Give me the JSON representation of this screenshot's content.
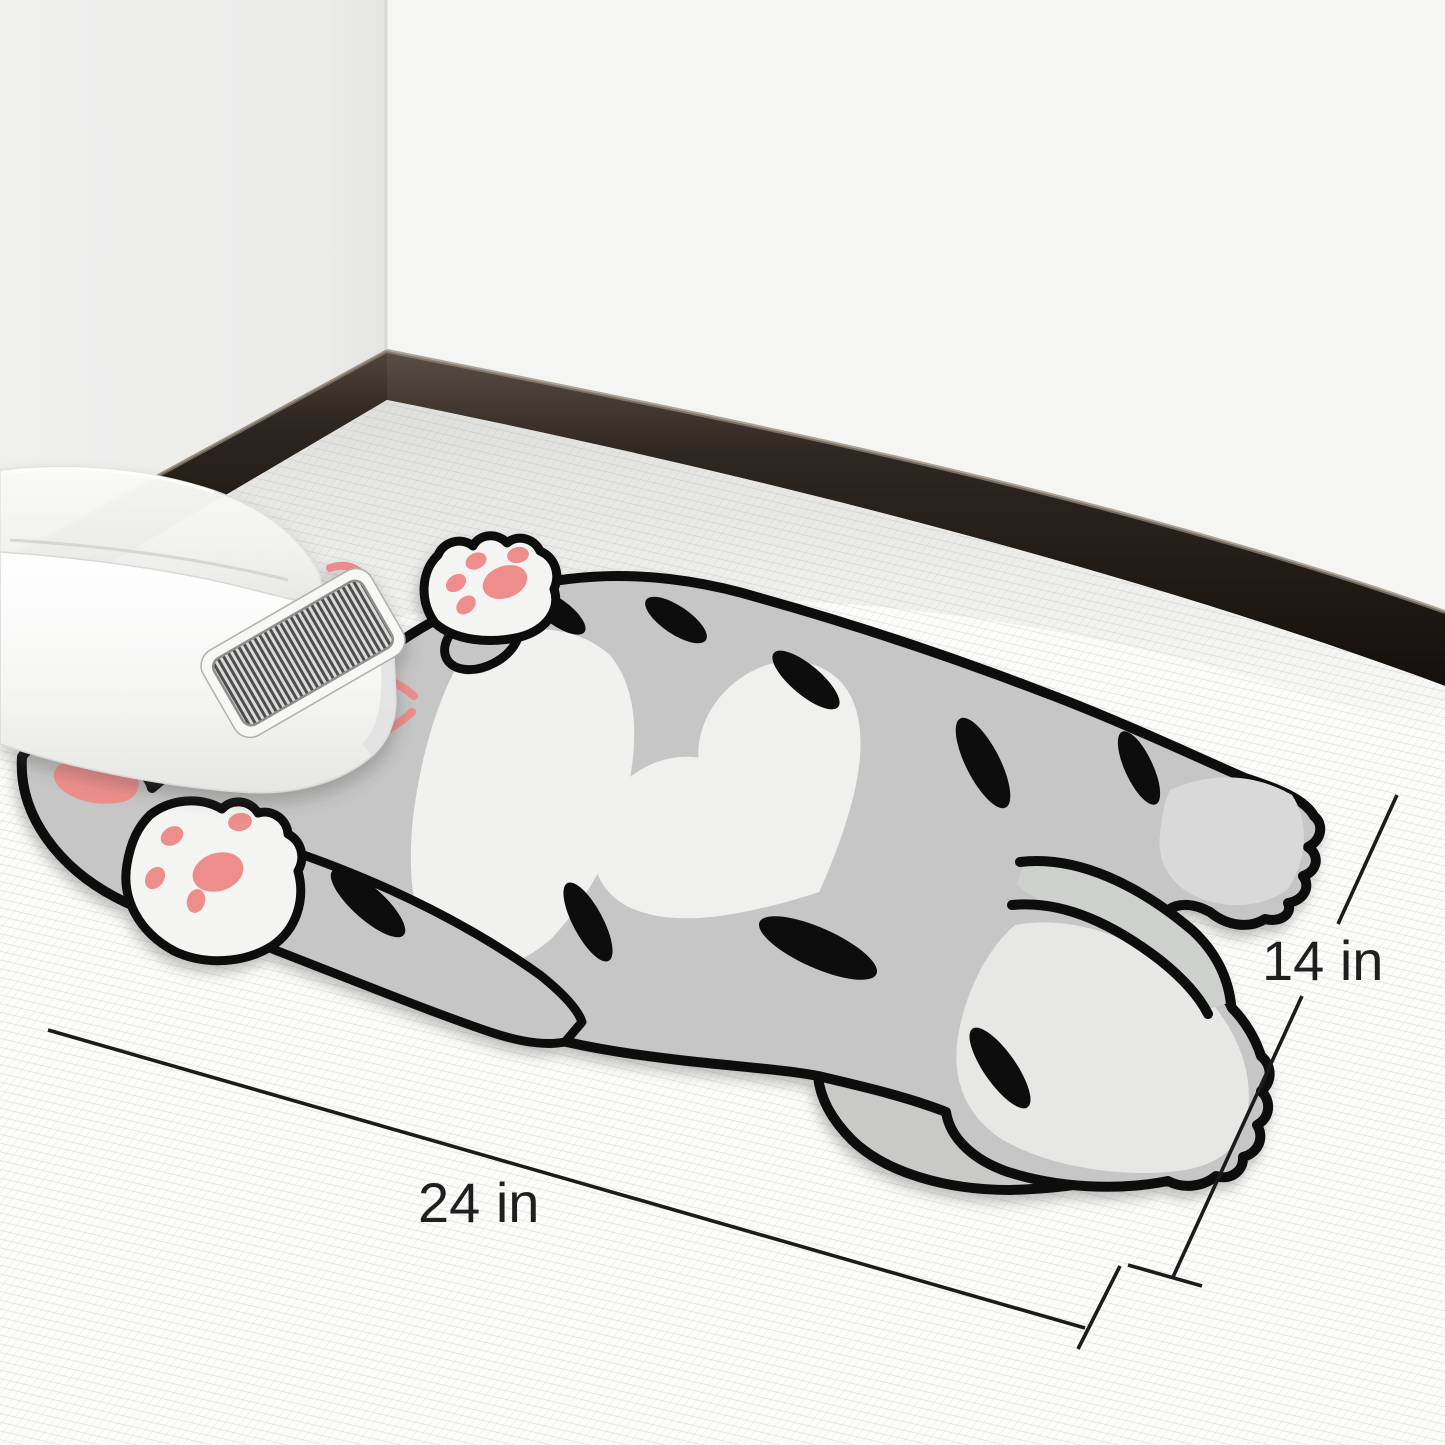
{
  "annotation": {
    "width_label": "24 in",
    "height_label": "14 in"
  },
  "colors": {
    "wall_left": "#ededec",
    "wall_right": "#f5f5f4",
    "baseboard_dark": "#221a14",
    "mat_base": "#fcfcfb",
    "cat_body_gray": "#c5c6c5",
    "cat_light_gray": "#d8d9d8",
    "cat_leg_gray": "#ced0ce",
    "cat_foot_gray": "#e7e7e6",
    "cat_white": "#f1f1f0",
    "paw_white": "#f4f4f3",
    "paw_pad_pink": "#ed8e8c",
    "outline_black": "#0d0d0d",
    "litter_beige": "#e9e1c5",
    "grate_slat_dark": "#4e4e4d",
    "dimension_line": "#1b1b1b",
    "dimension_text": "#1f1f1f"
  }
}
